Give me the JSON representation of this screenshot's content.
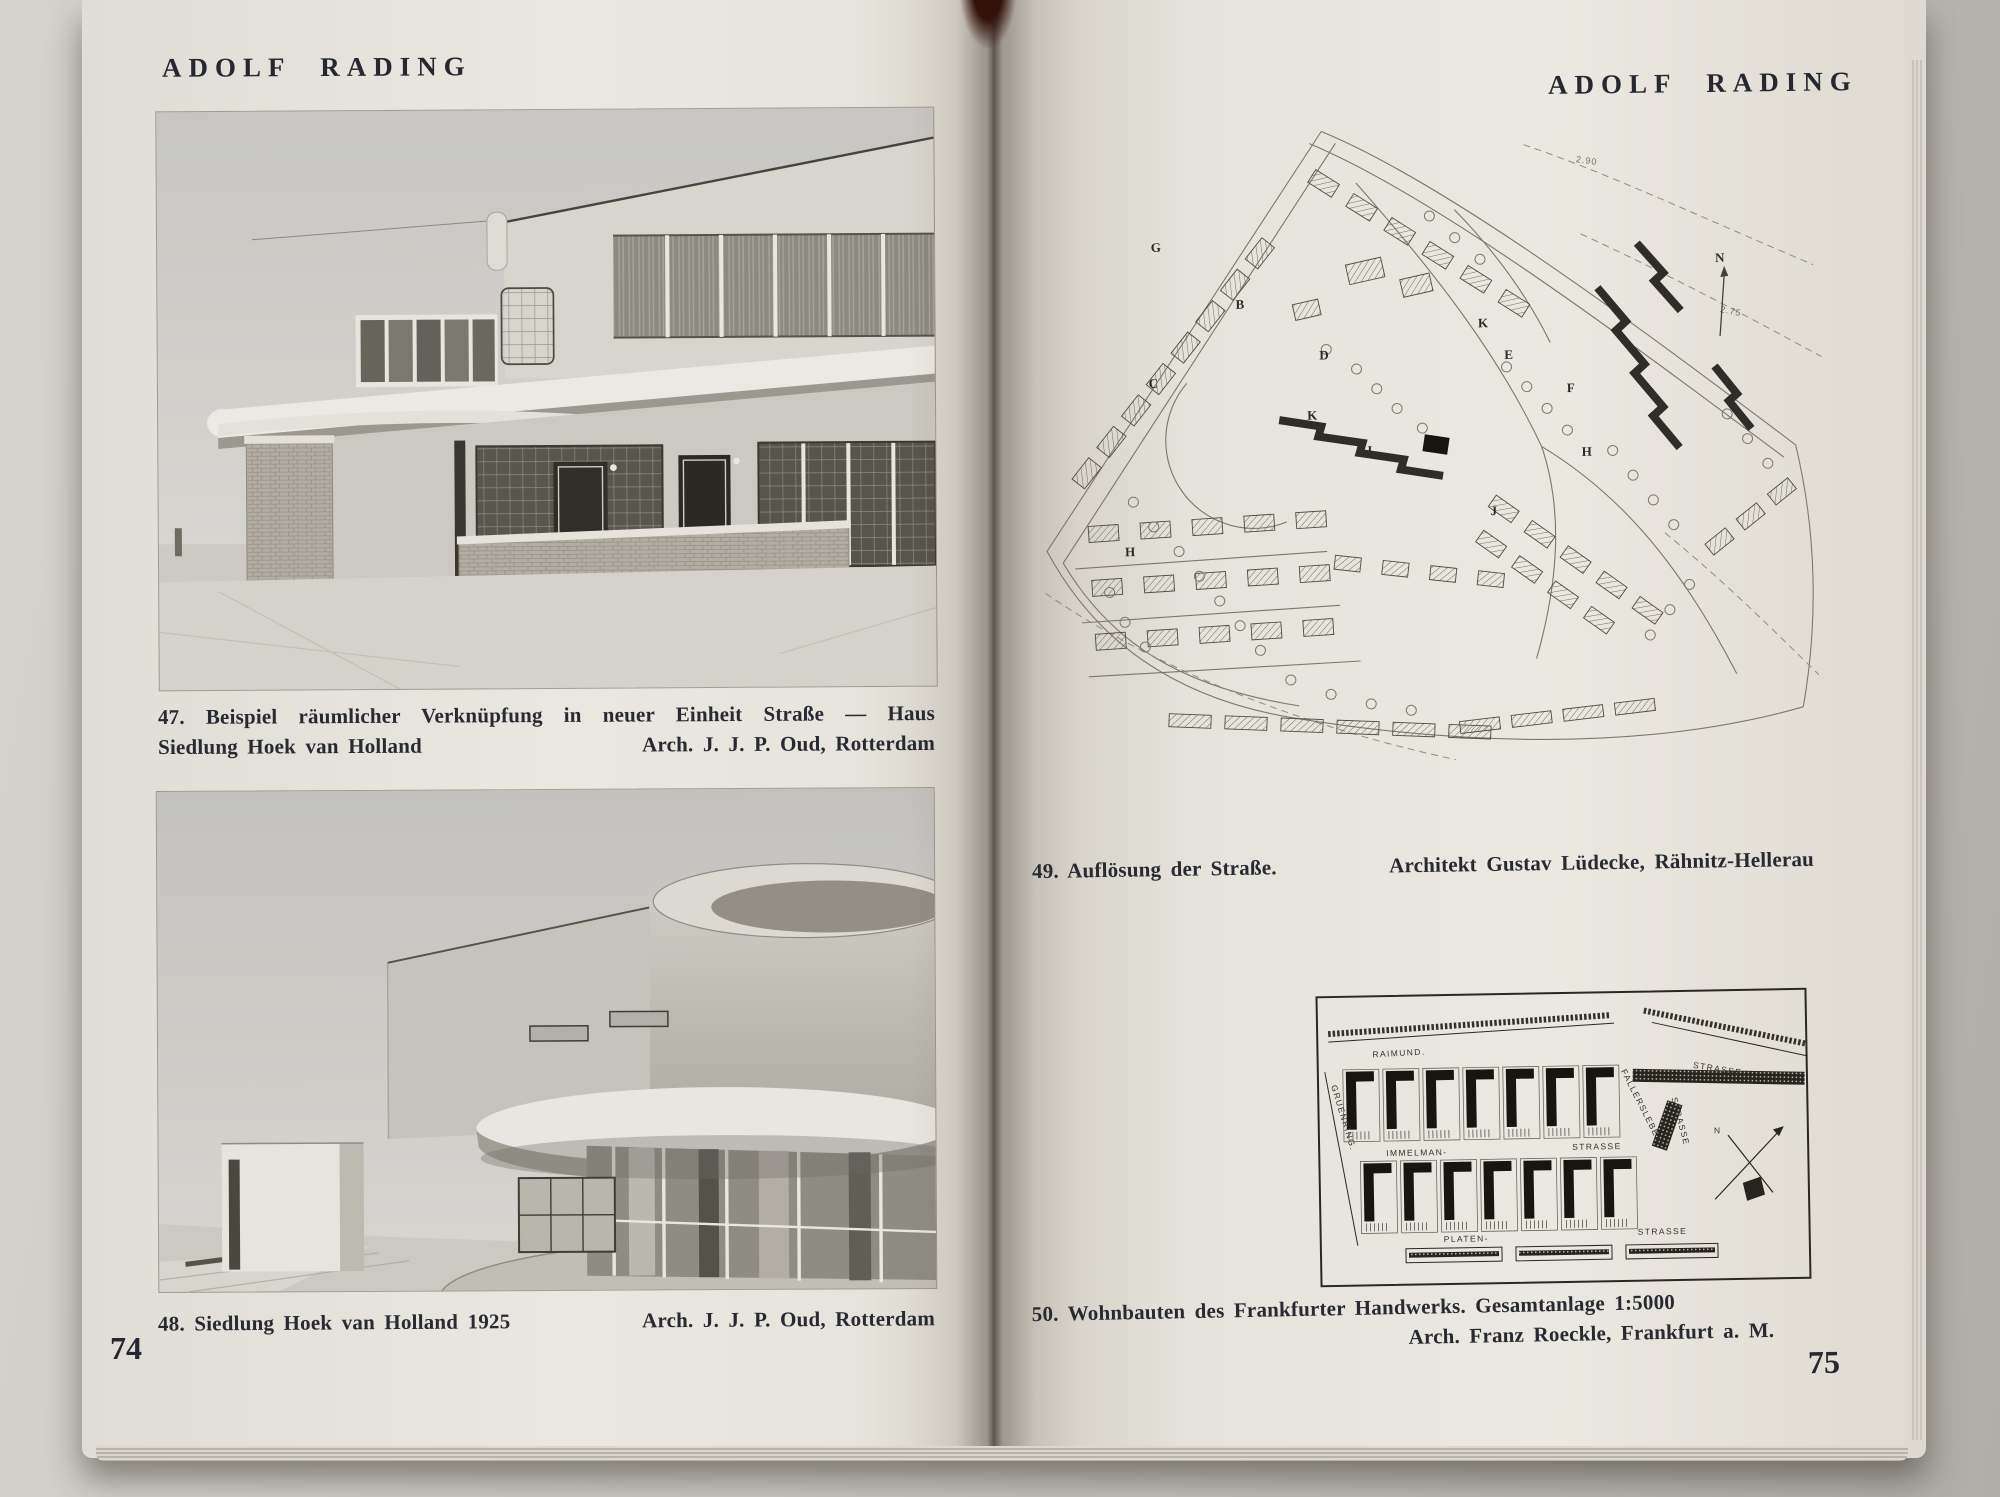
{
  "left_page": {
    "header": "ADOLF RADING",
    "page_number": "74",
    "fig47": {
      "caption_line1": "47. Beispiel räumlicher Verknüpfung in neuer Einheit Straße — Haus",
      "caption_line2_left": "Siedlung Hoek van Holland",
      "caption_line2_right": "Arch. J. J. P. Oud, Rotterdam"
    },
    "fig48": {
      "caption_left": "48. Siedlung Hoek van Holland 1925",
      "caption_right": "Arch. J. J. P. Oud, Rotterdam"
    }
  },
  "right_page": {
    "header": "ADOLF RADING",
    "page_number": "75",
    "fig49": {
      "caption_left": "49. Auflösung der Straße.",
      "caption_right": "Architekt Gustav Lüdecke, Rähnitz-Hellerau",
      "north_label": "N",
      "contour_labels": [
        "2.90",
        "2.75"
      ],
      "block_letters": [
        "G",
        "B",
        "D",
        "K",
        "E",
        "K",
        "C",
        "J",
        "H",
        "J",
        "H",
        "F"
      ]
    },
    "fig50": {
      "caption_line1": "50. Wohnbauten des Frankfurter Handwerks. Gesamtanlage 1:5000",
      "caption_line2": "Arch. Franz Roeckle, Frankfurt a. M.",
      "north_label": "N",
      "streets": {
        "top_left": "RAIMUND.",
        "top_right": "STRASSE",
        "mid_left": "IMMELMAN-",
        "mid_right": "STRASSE",
        "bottom_left": "PLATEN-",
        "bottom_right": "STRASSE",
        "left_diagonal": "GRUENRING.",
        "right_diagonal": "FALLERSLEBEN",
        "right_vertical": "STRASSE"
      }
    }
  },
  "colors": {
    "page": "#e9e6df",
    "ink": "#252830",
    "backdrop": "#c6c3be",
    "binding": "#34120b"
  }
}
